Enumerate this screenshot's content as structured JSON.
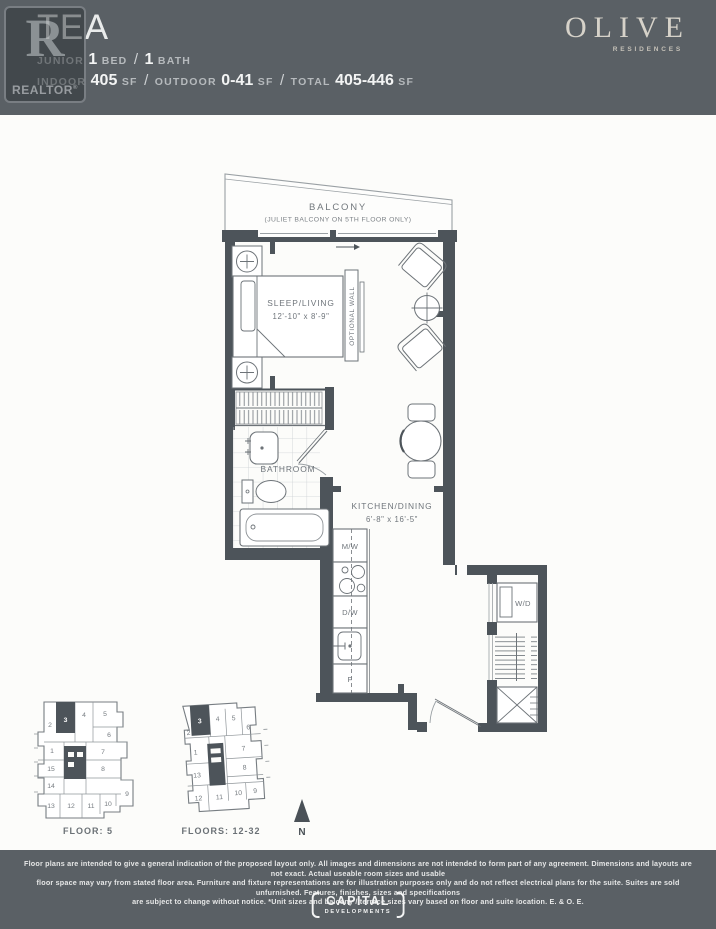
{
  "header": {
    "title": "TEA",
    "line1": {
      "junior": "JUNIOR",
      "bed_count": "1",
      "bed_label": "BED",
      "sep": "/",
      "bath_count": "1",
      "bath_label": "BATH"
    },
    "line2": {
      "indoor_label": "INDOOR",
      "indoor_value": "405",
      "indoor_unit": "SF",
      "sep1": "/",
      "outdoor_label": "OUTDOOR",
      "outdoor_value": "0-41",
      "outdoor_unit": "SF",
      "sep2": "/",
      "total_label": "TOTAL",
      "total_value": "405-446",
      "total_unit": "SF"
    },
    "brand": {
      "name": "OLIVE",
      "subtitle": "RESIDENCES"
    },
    "colors": {
      "header_bg": "#5a6065",
      "value_text": "#f3f4f4",
      "muted_text": "#b6babd",
      "brand_text": "#d6d2c9"
    }
  },
  "watermark": {
    "letter": "R",
    "label": "REALTOR",
    "reg": "®"
  },
  "plan": {
    "balcony_label": "BALCONY",
    "balcony_note": "(JULIET BALCONY ON 5TH FLOOR ONLY)",
    "sleep_living_label": "SLEEP/LIVING",
    "sleep_living_dims": "12'-10\" x 8'-9\"",
    "optional_wall_label": "OPTIONAL WALL",
    "bathroom_label": "BATHROOM",
    "kitchen_label": "KITCHEN/DINING",
    "kitchen_dims": "6'-8\" x 16'-5\"",
    "appliance_microwave": "M/W",
    "appliance_dishwasher": "D/W",
    "appliance_fridge": "F",
    "appliance_washer_dryer": "W/D",
    "colors": {
      "wall": "#4d545a",
      "furniture_line": "#6d7378",
      "label_text": "#72787d"
    }
  },
  "keyplans": [
    {
      "label": "FLOOR: 5",
      "highlighted_unit": "3",
      "units": [
        "2",
        "3",
        "4",
        "5",
        "6",
        "1",
        "7",
        "15",
        "8",
        "14",
        "13",
        "12",
        "11",
        "10",
        "9"
      ]
    },
    {
      "label": "FLOORS: 12-32",
      "highlighted_unit": "3",
      "units": [
        "2",
        "3",
        "4",
        "5",
        "6",
        "1",
        "7",
        "13",
        "8",
        "12",
        "11",
        "10",
        "9"
      ]
    }
  ],
  "north_label": "N",
  "footer": {
    "disclaimer_lines": [
      "Floor plans are intended to give a general indication of the proposed layout only. All images and dimensions are not intended to form part of any agreement. Dimensions and layouts are not exact. Actual useable room sizes and usable",
      "floor space may vary from stated floor area. Furniture and fixture representations are for illustration purposes only and do not reflect electrical plans for the suite. Suites are sold unfurnished. Features, finishes, sizes and specifications",
      "are subject to change without notice. *Unit sizes and balcony / terrace sizes vary based on floor and suite location. E. & O. E."
    ],
    "logo_top": "CAPITAL",
    "logo_bottom": "DEVELOPMENTS"
  }
}
